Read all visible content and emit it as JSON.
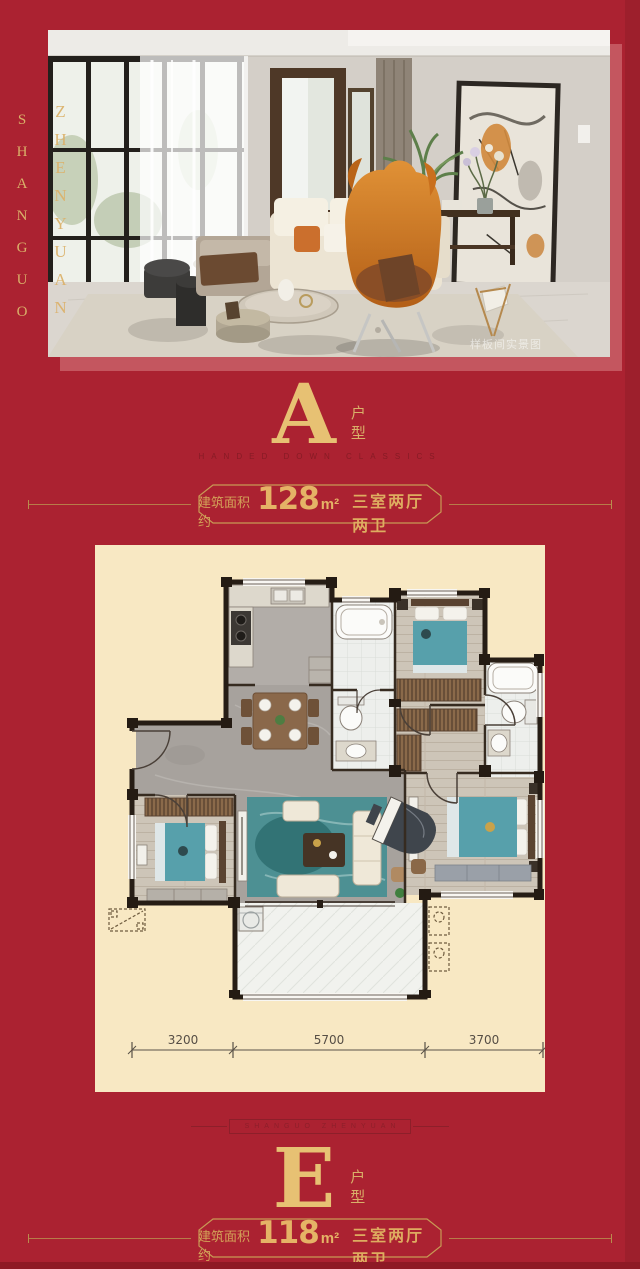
{
  "brand": {
    "vertical_left": "SHANGUO",
    "vertical_photo": "ZHENYUAN",
    "divider_text": "SHANGUO ZHENYUAN"
  },
  "photo": {
    "watermark": "样板间实景图"
  },
  "unit_a": {
    "letter": "A",
    "suffix": "户型",
    "tagline": "HANDED DOWN CLASSICS",
    "area_label": "建筑面积约",
    "area_value": "128",
    "area_unit": "m²",
    "rooms_label": "三室两厅两卫"
  },
  "unit_e": {
    "letter": "E",
    "suffix": "户型",
    "area_label": "建筑面积约",
    "area_value": "118",
    "area_unit": "m²",
    "rooms_label": "三室两厅两卫"
  },
  "floorplan": {
    "dims": [
      "3200",
      "5700",
      "3700"
    ]
  },
  "colors": {
    "background_red": "#ab2231",
    "gold": "#d9b069",
    "panel_cream": "#f8e8c3",
    "bed_teal": "#57a0ab"
  }
}
